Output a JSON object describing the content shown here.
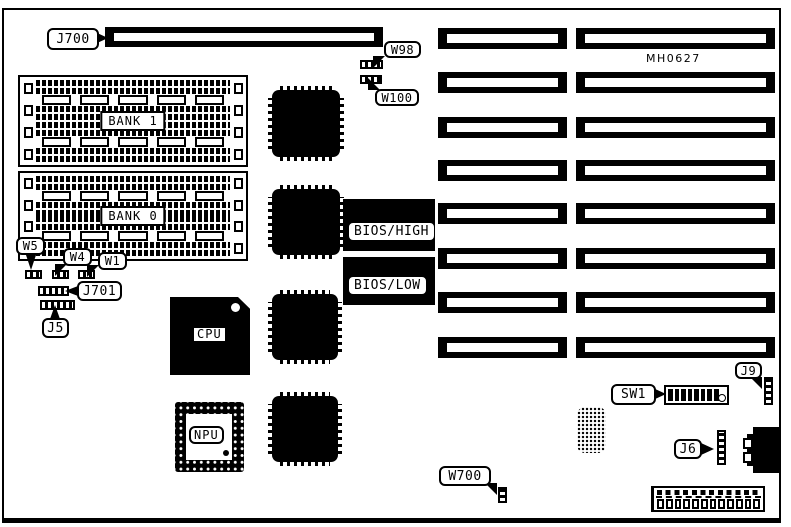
{
  "meta": {
    "ink_color": "#000000",
    "paper_color": "#ffffff",
    "description": "Motherboard component location diagram"
  },
  "part_number": "MH0627",
  "top_edge": {
    "slot_j700_label": "J700",
    "jumper_w98_label": "W98",
    "jumper_w100_label": "W100"
  },
  "memory": {
    "bank_top_label": "BANK 1",
    "bank_bottom_label": "BANK 0",
    "rows_per_bank": 4,
    "jumper_w5_label": "W5",
    "jumper_w4_label": "W4",
    "jumper_w1_label": "W1",
    "header_j701_label": "J701",
    "header_j5_label": "J5"
  },
  "chips": {
    "cpu": "CPU",
    "npu": "NPU",
    "bios_high": "BIOS/HIGH",
    "bios_low": "BIOS/LOW"
  },
  "bottom_right": {
    "dip_switch_label": "SW1",
    "header_j9_label": "J9",
    "header_j6_label": "J6",
    "jumper_w700_label": "W700"
  },
  "expansion": {
    "slot_rows": 8,
    "slots_per_row": 2
  }
}
